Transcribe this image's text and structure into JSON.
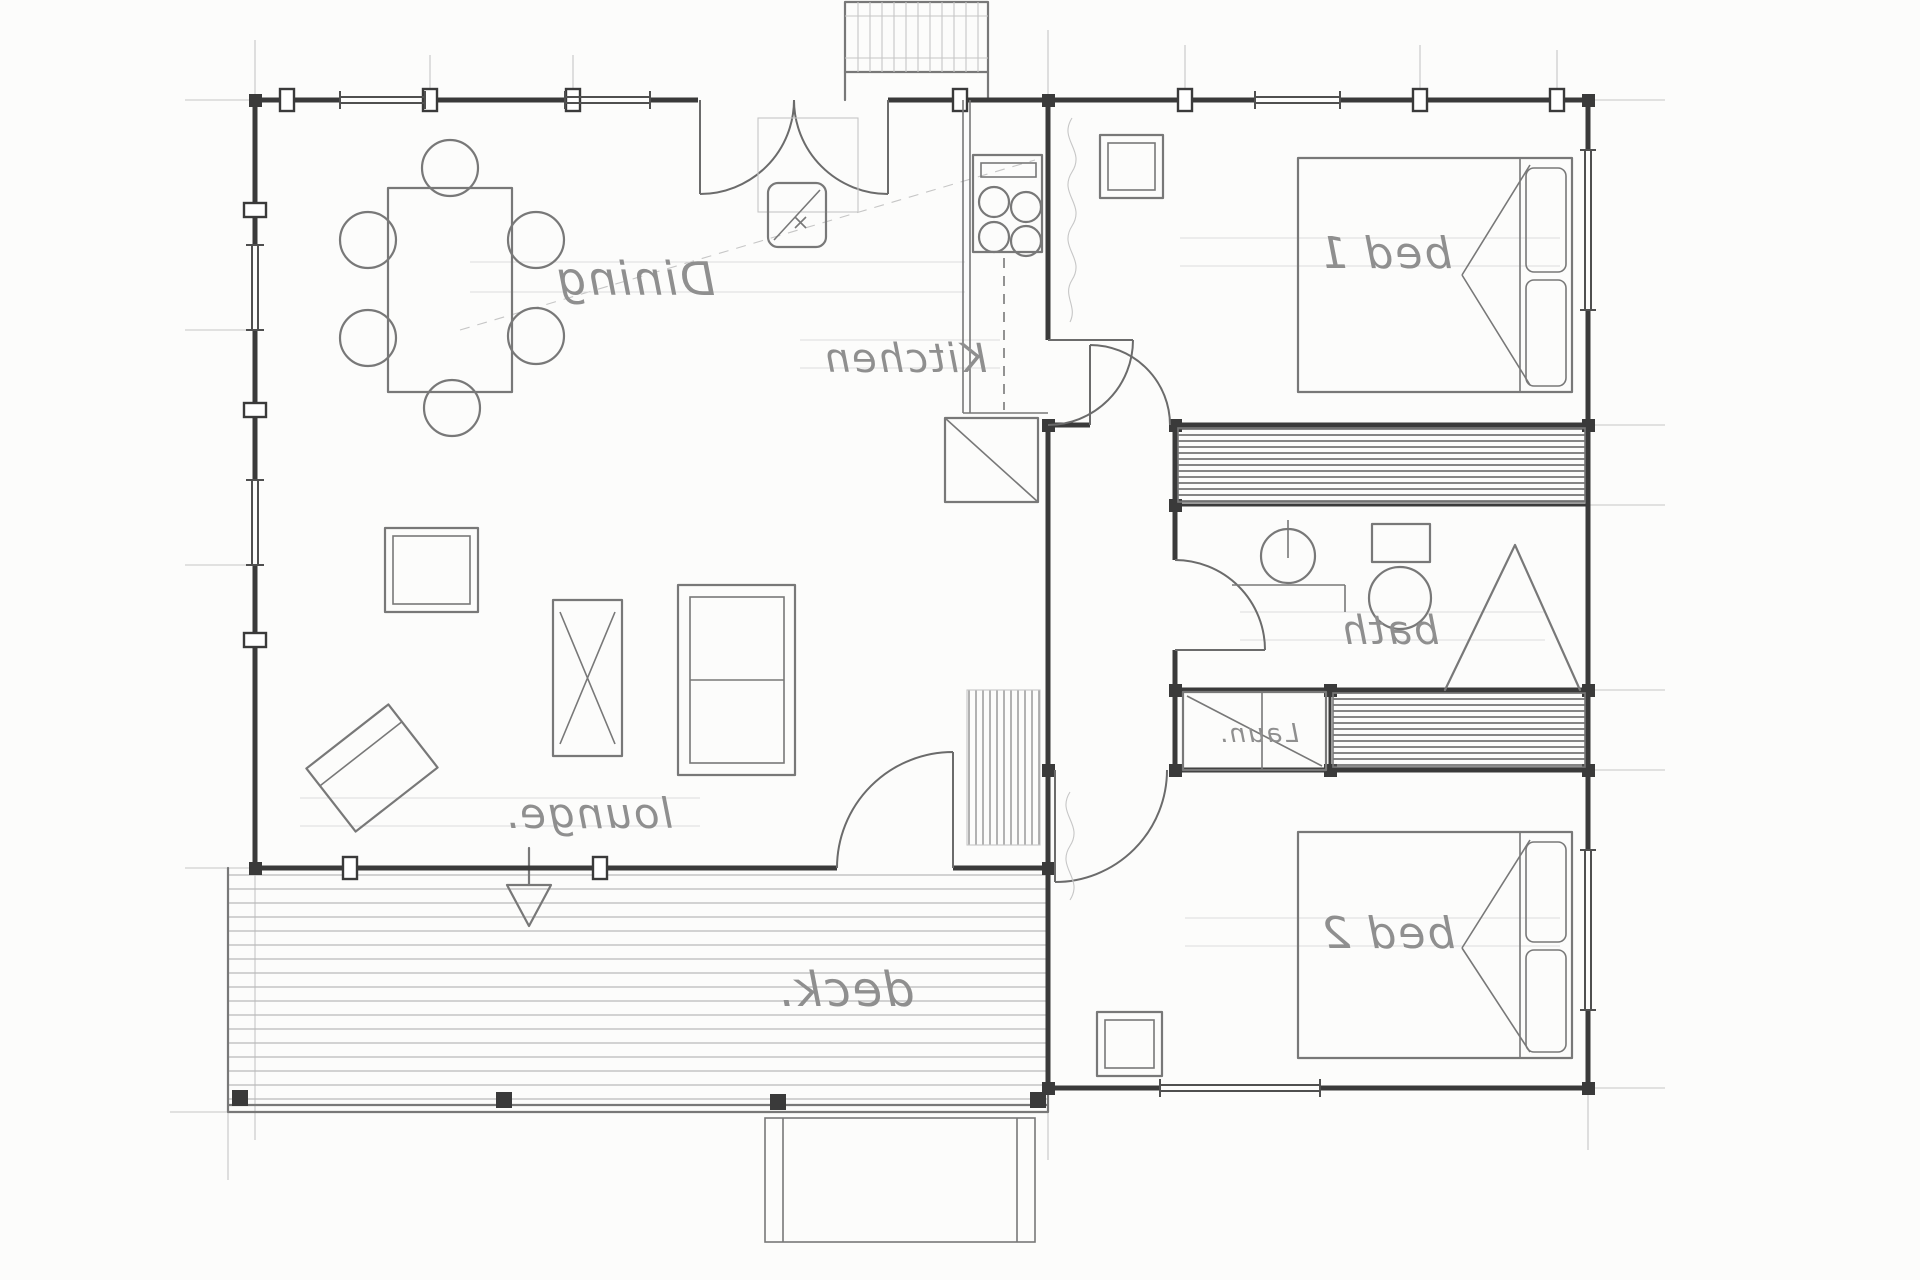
{
  "document": {
    "kind": "Hand-drawn architectural floor plan, pencil on paper, scanned mirrored (all text reads backwards)",
    "title": "Cottage floor plan sketch"
  },
  "style": {
    "paper": "#fcfcfb",
    "wall": "#3a3a3a",
    "pencil": "#787878",
    "guide": "#c6c6c6",
    "faint": "#dcdcdc",
    "label": "#8f8f8f",
    "hatch": "#525252",
    "plank": "#b9b9b9"
  },
  "labels": {
    "dining": "Dining",
    "kitchen": "Kitchen",
    "bed1": "bed 1",
    "bath": "bath",
    "laundry": "Laun.",
    "lounge": "lounge.",
    "bed2": "bed 2",
    "deck": "deck."
  },
  "fixtures": [
    "dining-table-with-6-chairs",
    "4-burner-cooktop",
    "kitchen-sink",
    "sofa",
    "coffee-table",
    "tv-cabinet",
    "armchair",
    "double-bed-1",
    "double-bed-2",
    "built-in-wardrobes",
    "wash-basin",
    "toilet",
    "shower-screen",
    "laundry-tub",
    "deck-steps",
    "entry-double-door",
    "deck-posts"
  ]
}
